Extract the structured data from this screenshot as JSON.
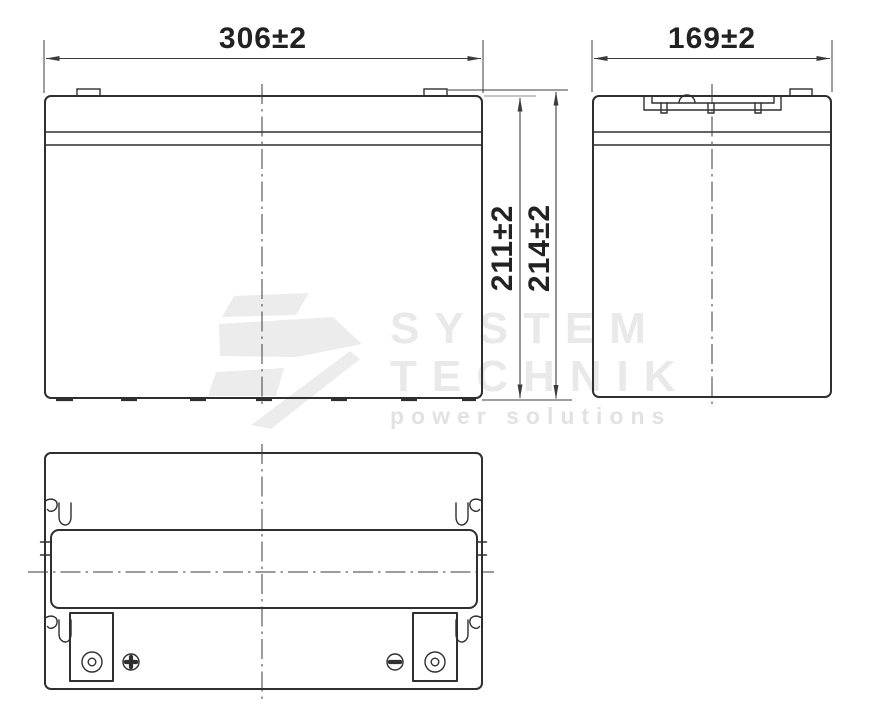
{
  "drawing": {
    "title": "battery-outline-dimension-drawing",
    "dimensions": {
      "front_width": "306±2",
      "side_width": "169±2",
      "case_height": "211±2",
      "total_height": "214±2"
    },
    "views": {
      "front": "front-view",
      "side": "side-view",
      "top": "top-view"
    },
    "icons": {
      "positive_terminal": "plus-in-circle",
      "negative_terminal": "minus-in-circle"
    },
    "colors": {
      "line": "#2f2f2f",
      "dimension": "#3c3c3c",
      "watermark_text": "#e9e9e9",
      "watermark_logo": "#ececec",
      "background": "#ffffff"
    },
    "watermark": {
      "line1": "SYSTEM",
      "line2": "TECHNIK",
      "tagline": "power solutions"
    }
  }
}
